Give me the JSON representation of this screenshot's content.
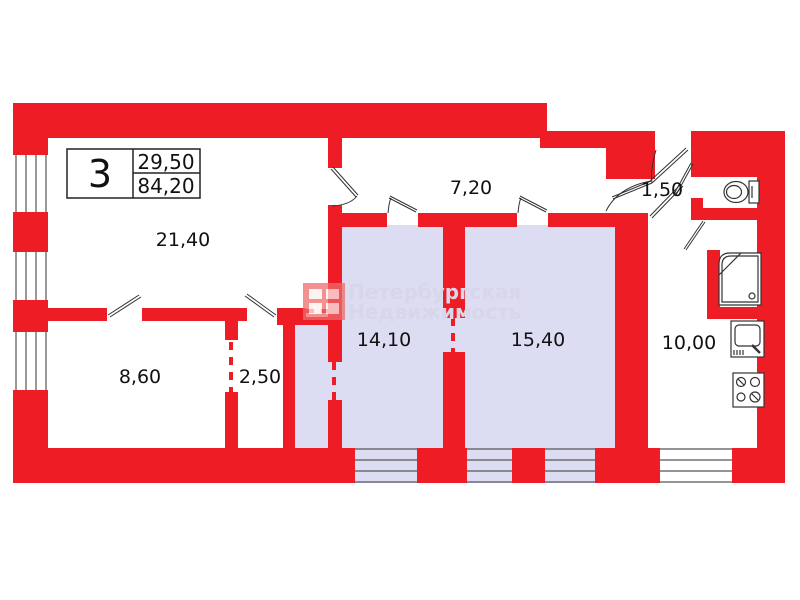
{
  "title_block": {
    "apartment_number": "3",
    "living_area": "29,50",
    "total_area": "84,20"
  },
  "watermark": {
    "line1": "Петербургская",
    "line2": "Недвижимость",
    "logo": "pn-window-logo"
  },
  "rooms": [
    {
      "name": "living-room",
      "area": "21,40"
    },
    {
      "name": "hallway",
      "area": "7,20"
    },
    {
      "name": "entrance-hall",
      "area": "1,50"
    },
    {
      "name": "room-left",
      "area": "8,60"
    },
    {
      "name": "closet",
      "area": "2,50"
    },
    {
      "name": "room-middle",
      "area": "14,10"
    },
    {
      "name": "room-right",
      "area": "15,40"
    },
    {
      "name": "kitchen",
      "area": "10,00"
    }
  ],
  "fixtures": {
    "toilet": "toilet-icon",
    "shower": "shower-icon",
    "sink": "sink-icon",
    "stove": "stove-icon"
  },
  "colors": {
    "wall_red": "#ee1c25",
    "room_fill_lavender": "#dcdcf2",
    "room_fill_white": "#ffffff",
    "line_dark": "#444444",
    "label_black": "#111111",
    "watermark_gray": "#d7d7e9"
  }
}
